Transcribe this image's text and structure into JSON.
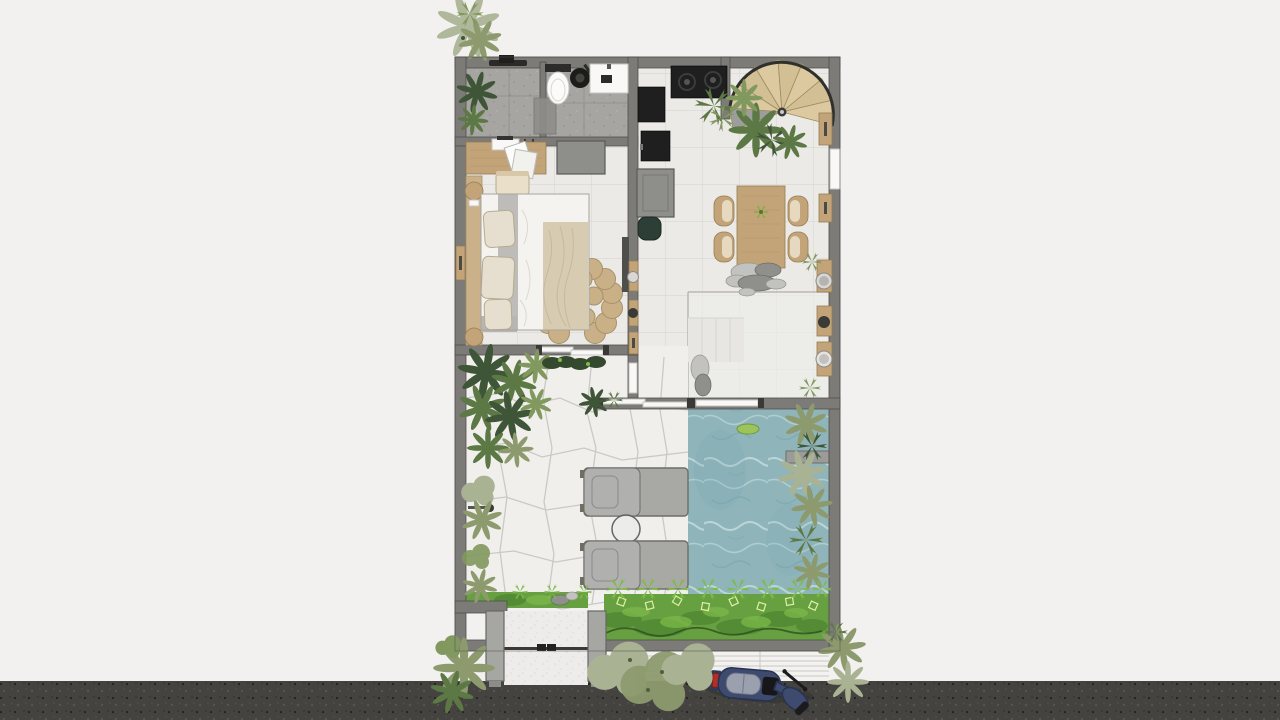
{
  "title": "villa-floor-plan-rendering",
  "palette": {
    "background": "#f2f1ef",
    "road": "#45433f",
    "wall": "#7c7b77",
    "wall_edge": "#504f4b",
    "bath_floor": "#a7a5a1",
    "tile": "#ebeae7",
    "grout": "#d9d8d4",
    "flag_base": "#f0efec",
    "flag_joint": "#c6c5c0",
    "wood": "#c2a478",
    "wood_dark": "#967c54",
    "wood_pale": "#dcc9a0",
    "black": "#1f1f1f",
    "cabinet": "#8e8e8b",
    "pool": "#8fb5bb",
    "ripple_light": "#c6dee0",
    "ripple_dark": "#76a3aa",
    "lounger": "#a8a8a5",
    "lounger_edge": "#6d6d6a",
    "rug": "#c9b086",
    "rug_edge": "#a8906a",
    "duvet": "#f4f3f0",
    "linen": "#e6dfcf",
    "throw": "#d7cbb2",
    "blanket_gray": "#b8b6b1",
    "pouf": "#2c3e35",
    "green_dark": "#3f5537",
    "green_mid": "#5c7845",
    "green_light": "#81985e",
    "sage": "#a9b293",
    "olive": "#8d9a6e",
    "bed_green": "#67a040",
    "bed_green_dark": "#447c2c",
    "leaf_bright": "#7dbb4a",
    "pebble_light": "#c2c2c0",
    "pebble_dark": "#8f8f8c",
    "gate_pillar": "#a6a6a3",
    "gate_bar": "#3a3936",
    "scooter_body": "#3e4a6e",
    "scooter_seat": "#9aa0ad",
    "scooter_tail": "#b03028",
    "sidewalk": "#f3f2f0",
    "sidewalk_line": "#c9c8c5",
    "white": "#f9f8f6"
  },
  "scene": {
    "type": "top-down architectural floor plan, photoreal render style",
    "rooms": [
      "bathroom",
      "bedroom",
      "kitchen",
      "dining-area",
      "living-terrace",
      "courtyard-garden",
      "pool"
    ],
    "objects": {
      "spiral_stair_treads": 8,
      "dining_chairs": 4,
      "sun_loungers": 2,
      "gate_pillars": 2,
      "scooters": 1,
      "toilets": 1,
      "beds": 1,
      "stove_burners": 2,
      "wall_planter_pots": 5
    }
  }
}
